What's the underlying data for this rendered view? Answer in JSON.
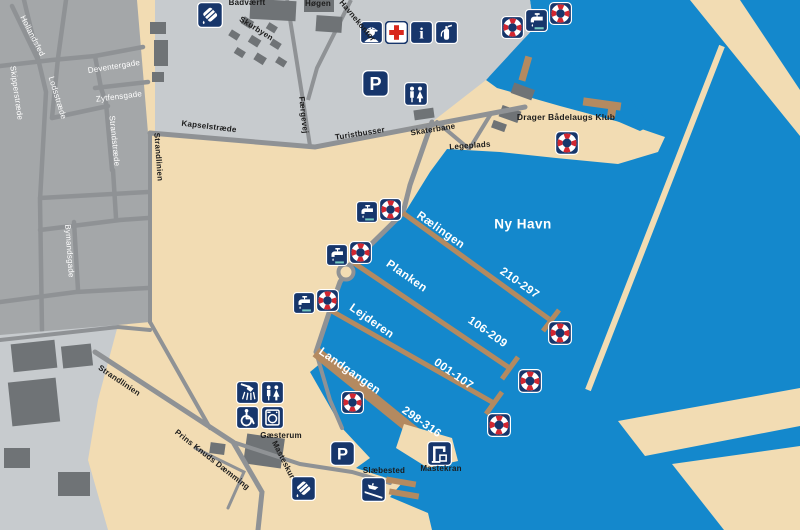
{
  "harbor": {
    "name": "Ny Havn",
    "club": "Drager Bådelaugs Klub"
  },
  "piers": [
    {
      "name": "Rælingen",
      "berths": "210-297"
    },
    {
      "name": "Planken",
      "berths": "106-209"
    },
    {
      "name": "Lejderen",
      "berths": "001-107"
    },
    {
      "name": "Landgangen",
      "berths": "298-316"
    }
  ],
  "streets": {
    "hollandsfed": "Hollandsfed",
    "skipperstraede": "Skipperstræde",
    "lodsstraede": "Lodsstræde",
    "deventergade": "Deventergade",
    "zytfensgade": "Zytfensgade",
    "strandstraede": "Strandstræde",
    "strandlinien_n": "Strandlinien",
    "strandlinien_s": "Strandlinien",
    "bymandsgade": "Bymandsgade",
    "kapselstraede": "Kapselstræde",
    "faergevej": "Færgevej",
    "prins_knuds": "Prins Knuds Dæmming"
  },
  "places": {
    "baadvaerft": "Bådværft",
    "hoegen": "Høgen",
    "skurbyen": "Skurbyen",
    "havnekontor": "Havnekontor",
    "turistbusser": "Turistbusser",
    "skaterbane": "Skaterbane",
    "legeplads": "Legeplads",
    "gaesterum": "Gæsterum",
    "masteskur": "Masteskur",
    "slaebested": "Slæbested",
    "mastekran": "Mastekran"
  },
  "icons": [
    {
      "name": "lifebuoy-icon",
      "glyph": "red-white life ring on navy square"
    },
    {
      "name": "water-tap-icon",
      "glyph": "faucet with drop and basin"
    },
    {
      "name": "parking-icon",
      "glyph": "white letter P"
    },
    {
      "name": "toilets-icon",
      "glyph": "man and woman figures"
    },
    {
      "name": "shower-icon",
      "glyph": "shower head with spray"
    },
    {
      "name": "wheelchair-icon",
      "glyph": "wheelchair user"
    },
    {
      "name": "laundry-icon",
      "glyph": "washing machine"
    },
    {
      "name": "first-aid-icon",
      "glyph": "red cross on white"
    },
    {
      "name": "info-icon",
      "glyph": "serif letter i"
    },
    {
      "name": "harbormaster-icon",
      "glyph": "officer with peaked cap"
    },
    {
      "name": "fire-extinguisher-icon",
      "glyph": "extinguisher bottle"
    },
    {
      "name": "mast-crane-icon",
      "glyph": "gantry crane"
    },
    {
      "name": "slipway-icon",
      "glyph": "boat on ramp"
    },
    {
      "name": "oil-drum-icon",
      "glyph": "tilted drum with drop"
    }
  ],
  "colors": {
    "water": "#1488cc",
    "sand": "#f2dcb3",
    "urban": "#a4a7a9",
    "industrial_yard": "#c7cbce",
    "building": "#6f7376",
    "road": "#8f9295",
    "pier": "#b48a60",
    "icon_navy": "#17366b",
    "icon_red": "#d22630"
  }
}
